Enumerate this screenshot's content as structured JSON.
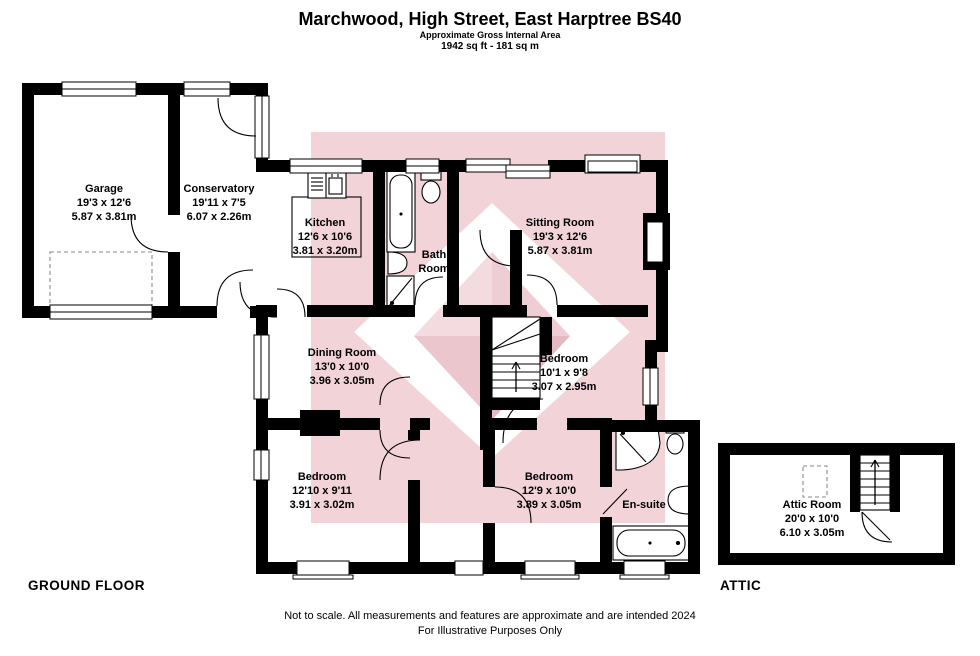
{
  "header": {
    "title": "Marchwood, High Street, East Harptree BS40",
    "subtitle": "Approximate Gross Internal Area",
    "area": "1942 sq ft - 181 sq m"
  },
  "floor_labels": {
    "ground": "GROUND FLOOR",
    "attic": "ATTIC"
  },
  "rooms": [
    {
      "name": "Garage",
      "dims_ft": "19'3 x 12'6",
      "dims_m": "5.87 x 3.81m"
    },
    {
      "name": "Conservatory",
      "dims_ft": "19'11 x 7'5",
      "dims_m": "6.07 x 2.26m"
    },
    {
      "name": "Kitchen",
      "dims_ft": "12'6 x 10'6",
      "dims_m": "3.81 x 3.20m"
    },
    {
      "name": "Bath Room",
      "dims_ft": "",
      "dims_m": ""
    },
    {
      "name": "Sitting Room",
      "dims_ft": "19'3 x 12'6",
      "dims_m": "5.87 x 3.81m"
    },
    {
      "name": "Dining Room",
      "dims_ft": "13'0 x 10'0",
      "dims_m": "3.96 x 3.05m"
    },
    {
      "name": "Bedroom",
      "dims_ft": "10'1 x 9'8",
      "dims_m": "3.07 x 2.95m"
    },
    {
      "name": "Bedroom",
      "dims_ft": "12'10 x 9'11",
      "dims_m": "3.91 x 3.02m"
    },
    {
      "name": "Bedroom",
      "dims_ft": "12'9 x 10'0",
      "dims_m": "3.89 x 3.05m"
    },
    {
      "name": "En-suite",
      "dims_ft": "",
      "dims_m": ""
    },
    {
      "name": "Attic Room",
      "dims_ft": "20'0 x 10'0",
      "dims_m": "6.10 x 3.05m"
    }
  ],
  "footer": {
    "line1": "Not to scale. All measurements and features are approximate and are intended 2024",
    "line2": "For Illustrative Purposes Only"
  },
  "colors": {
    "wall": "#000000",
    "wm_square": "#f1d3d8",
    "wm_diamond": "#ffffff",
    "wm_face_tl": "#f4dbe0",
    "wm_face_tr": "#eecdd4",
    "wm_face_bl": "#ebc6cd",
    "wm_face_br": "#e5b9c1"
  }
}
